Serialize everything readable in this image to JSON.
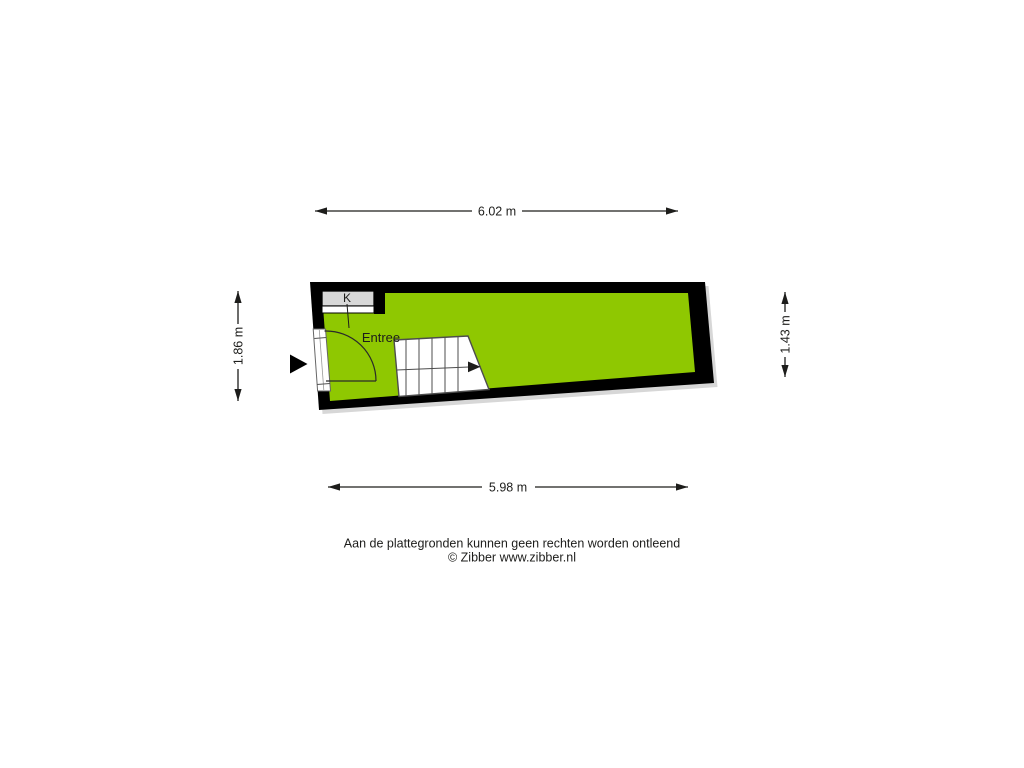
{
  "floorplan": {
    "room_label": "Entree",
    "closet_label": "K",
    "dimensions": {
      "top": "6.02 m",
      "bottom": "5.98 m",
      "left": "1.86 m",
      "right": "1.43 m"
    },
    "colors": {
      "floor": "#8fc801",
      "wall": "#000000",
      "counter": "#d8d8d8",
      "counter_front": "#ffffff",
      "shadow": "#c9c9c9"
    }
  },
  "footer": {
    "line1": "Aan de plattegronden kunnen geen rechten worden ontleend",
    "line2": "© Zibber www.zibber.nl"
  }
}
